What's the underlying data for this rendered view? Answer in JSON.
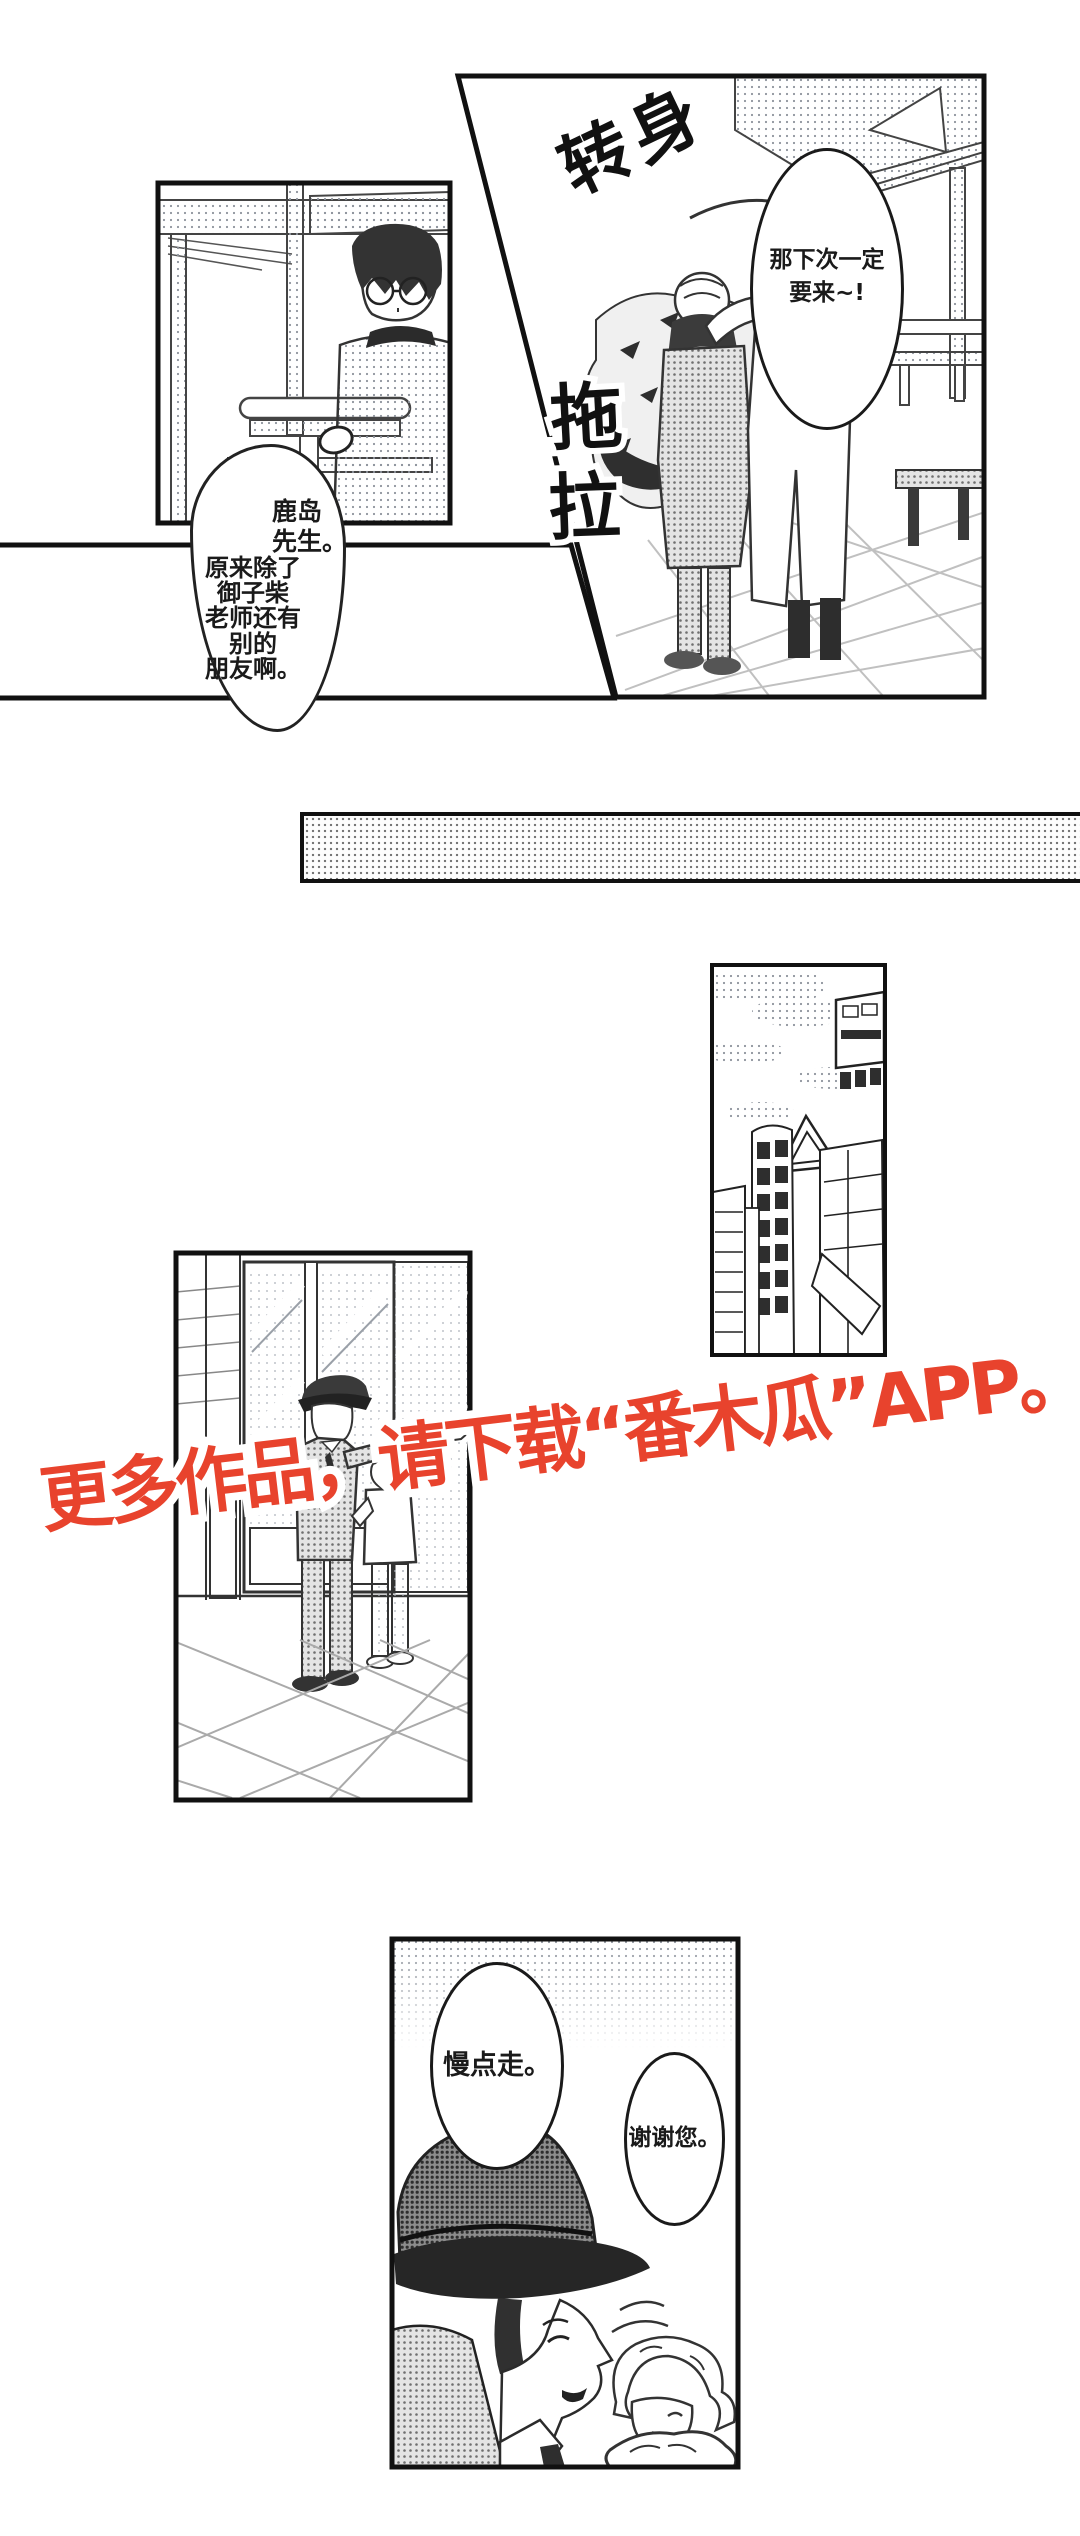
{
  "page": {
    "width": 1080,
    "height": 2536,
    "background": "#ffffff"
  },
  "colors": {
    "watermark_red": "#e8432d",
    "ink": "#1a1a1a",
    "panel_border": "#111111"
  },
  "panel_top_right": {
    "sfx_turn": "转身",
    "sfx_drag_char1": "拖",
    "sfx_drag_char2": "拉",
    "speech_bubble": {
      "line1": "那下次一定",
      "line2": "要来~!"
    }
  },
  "thought_bubble": {
    "name_lines": "鹿岛\n先生。",
    "body_lines": "原来除了\n御子柴\n老师还有\n别的\n朋友啊。"
  },
  "watermark": {
    "text": "更多作品，请下载“番木瓜”APP。"
  },
  "panel_bottom": {
    "speech_officer": "慢点走。",
    "speech_elder": "谢谢您。"
  }
}
